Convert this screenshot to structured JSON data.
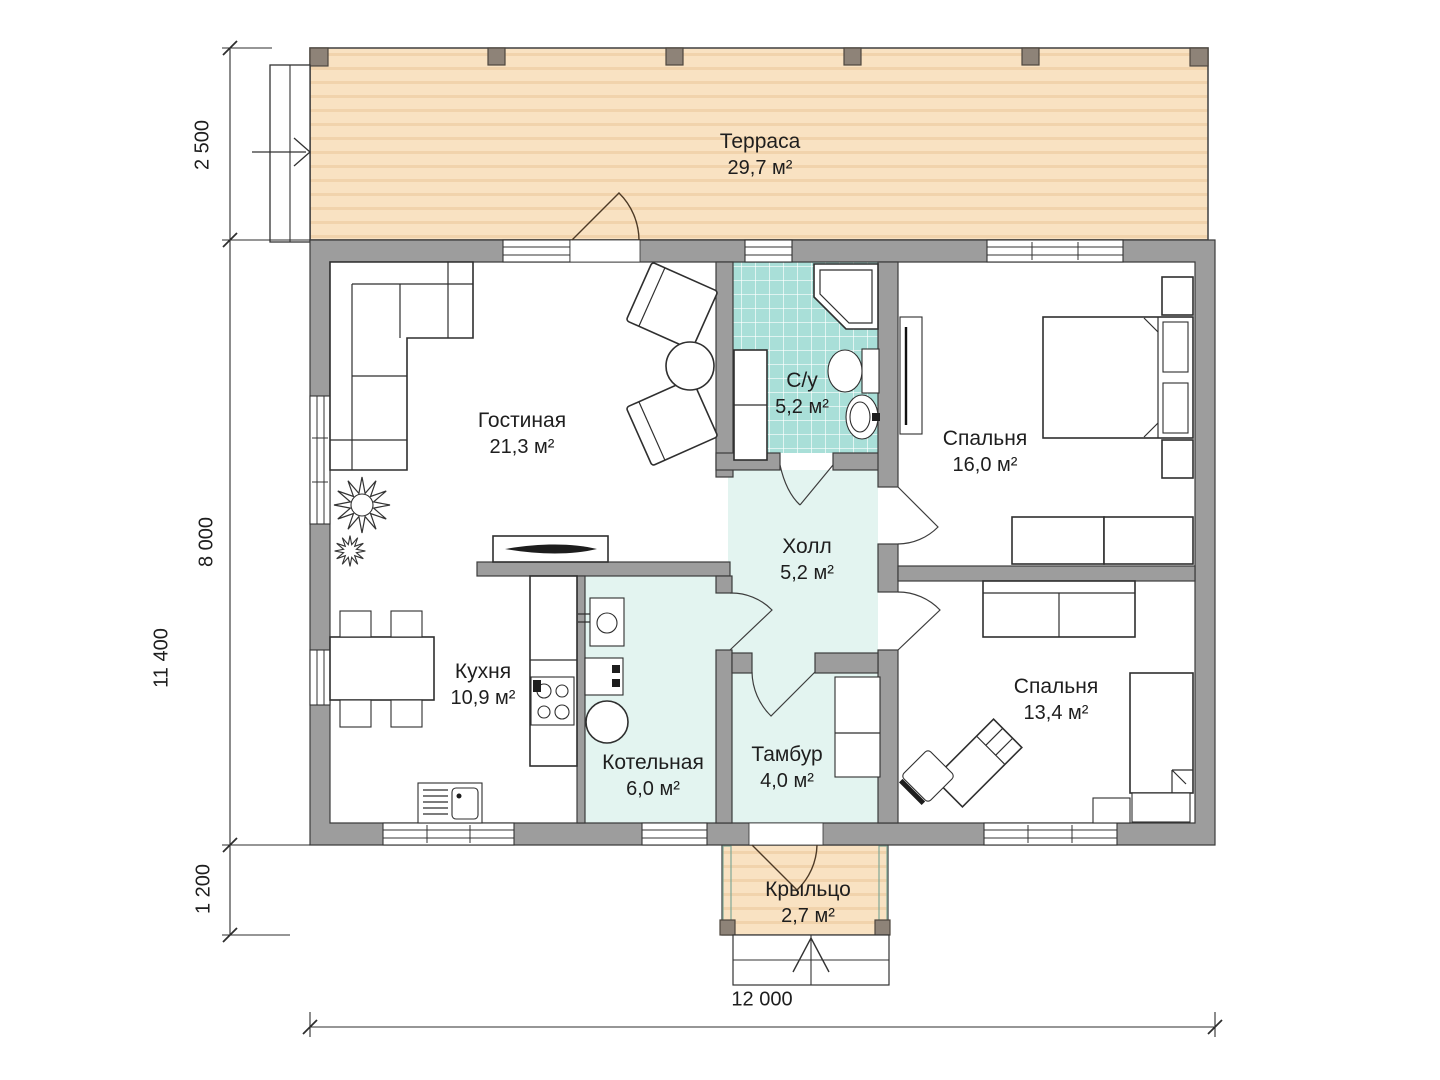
{
  "plan_title": "single-storey house floor plan",
  "rooms": [
    {
      "id": "terrace",
      "name": "Терраса",
      "area": "29,7 м²"
    },
    {
      "id": "living",
      "name": "Гостиная",
      "area": "21,3 м²"
    },
    {
      "id": "bathroom",
      "name": "С/у",
      "area": "5,2 м²"
    },
    {
      "id": "bedroom-main",
      "name": "Спальня",
      "area": "16,0 м²"
    },
    {
      "id": "hall",
      "name": "Холл",
      "area": "5,2 м²"
    },
    {
      "id": "kitchen",
      "name": "Кухня",
      "area": "10,9 м²"
    },
    {
      "id": "boiler",
      "name": "Котельная",
      "area": "6,0 м²"
    },
    {
      "id": "vestibule",
      "name": "Тамбур",
      "area": "4,0 м²"
    },
    {
      "id": "bedroom-second",
      "name": "Спальня",
      "area": "13,4 м²"
    },
    {
      "id": "porch",
      "name": "Крыльцо",
      "area": "2,7 м²"
    }
  ],
  "dimensions": {
    "terrace_depth": "2 500",
    "house_depth": "8 000",
    "porch_depth": "1 200",
    "total_height": "11 400",
    "total_width": "12 000"
  },
  "colors": {
    "terrace": "#f9e2c2",
    "terrace_stripe": "#f1d3ac",
    "tile": "#a9dfd8",
    "tile_line": "#ffffff",
    "service": "#e3f4f0",
    "wall": "#9d9d9d",
    "wall_stroke": "#3c3c3c",
    "post": "#8e8378",
    "door": "#4d3a26"
  }
}
